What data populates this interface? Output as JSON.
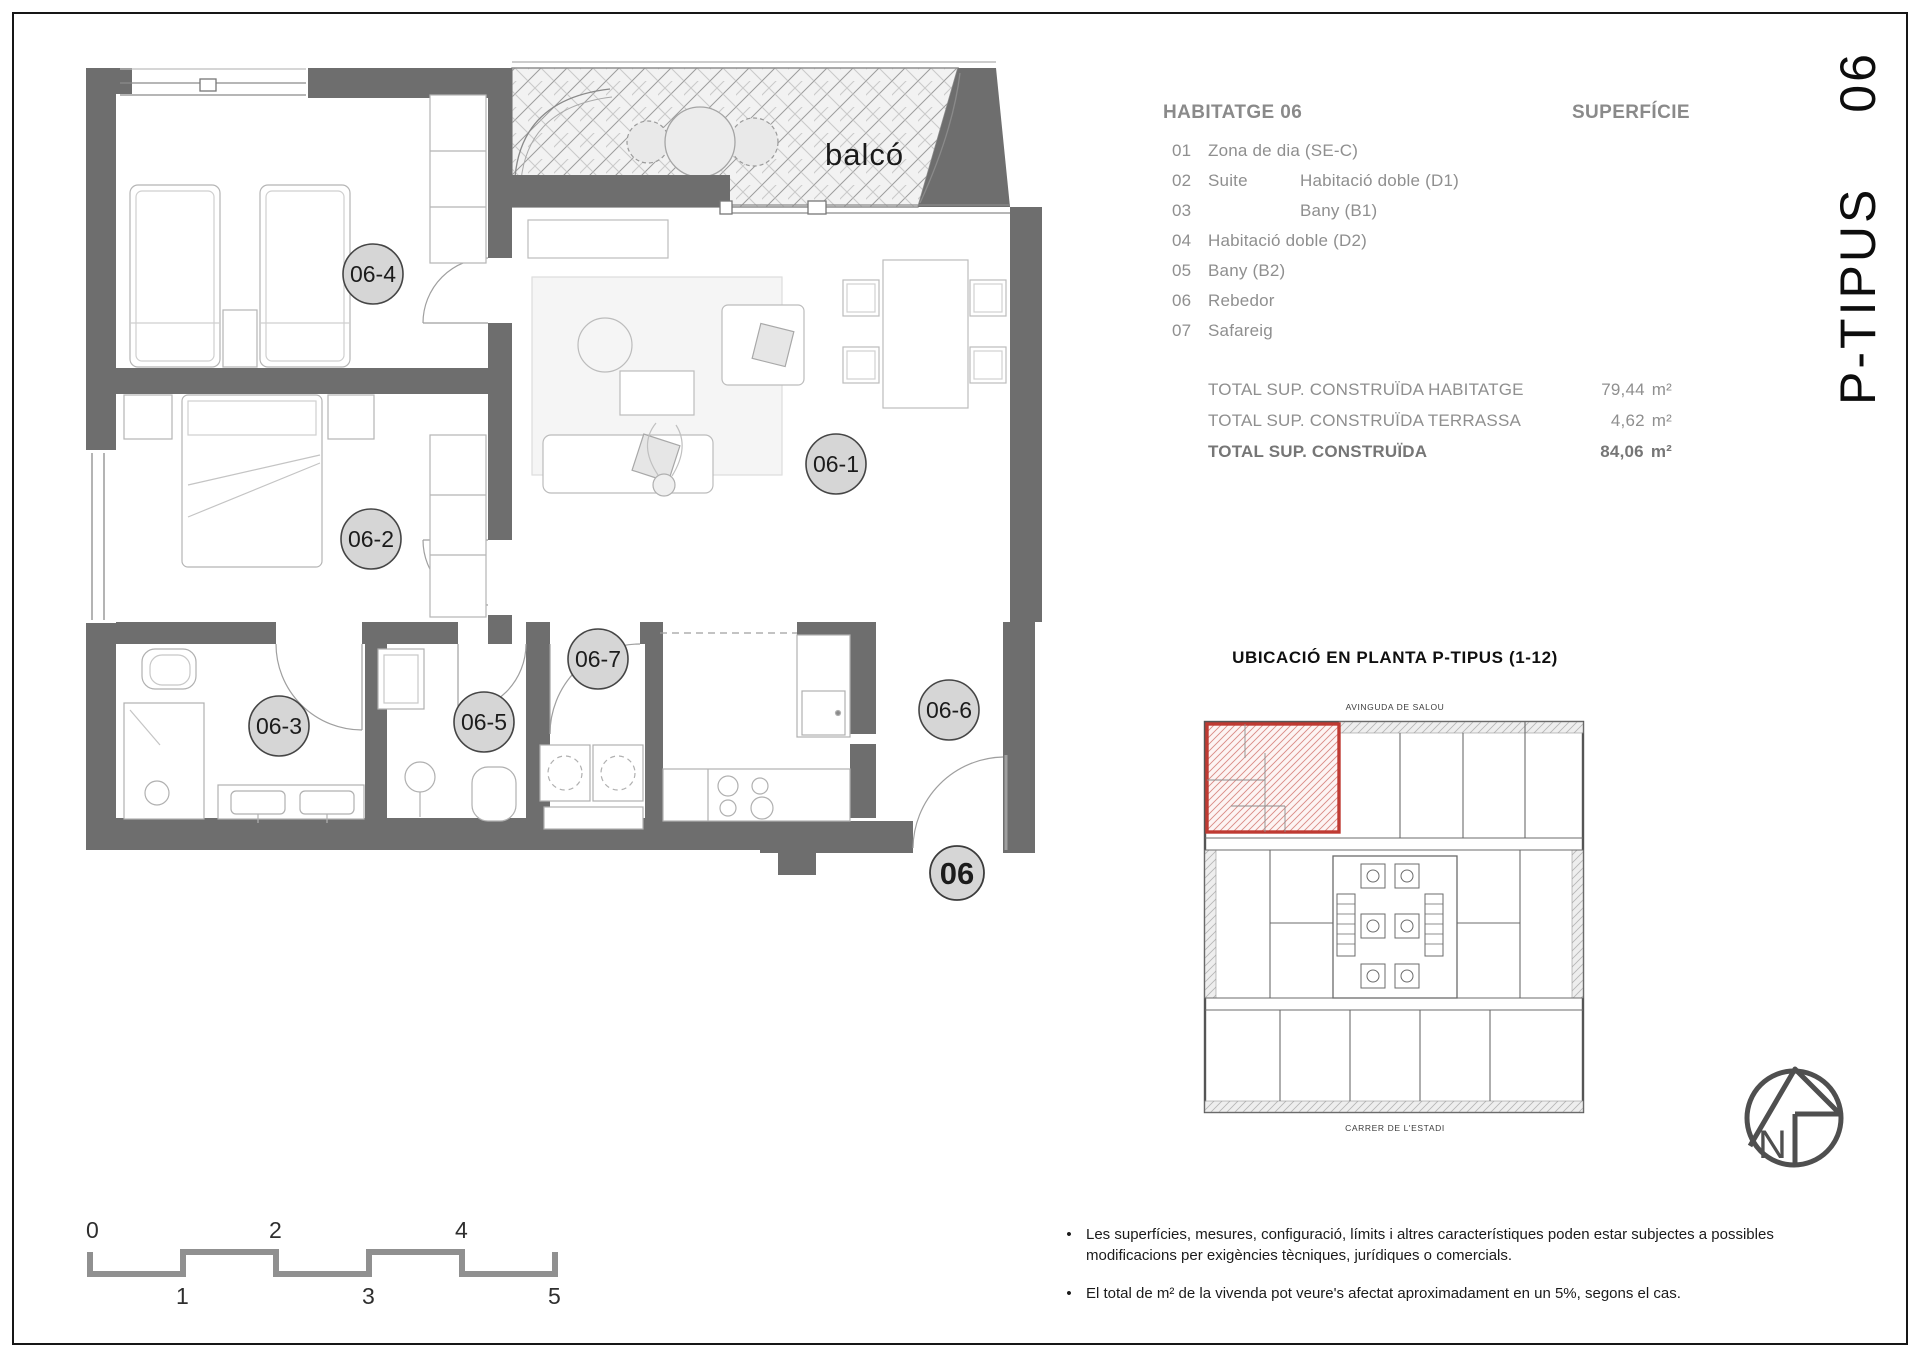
{
  "sheet": {
    "code_prefix": "P-TIPUS",
    "code_number": "06"
  },
  "legend": {
    "title": "HABITATGE 06",
    "superficie_label": "SUPERFÍCIE",
    "items": [
      {
        "num": "01",
        "col1": "Zona de dia (SE-C)",
        "col2": ""
      },
      {
        "num": "02",
        "col1": "Suite",
        "col2": "Habitació doble (D1)"
      },
      {
        "num": "03",
        "col1": "",
        "col2": "Bany (B1)"
      },
      {
        "num": "04",
        "col1": "Habitació doble (D2)",
        "col2": ""
      },
      {
        "num": "05",
        "col1": "Bany (B2)",
        "col2": ""
      },
      {
        "num": "06",
        "col1": "Rebedor",
        "col2": ""
      },
      {
        "num": "07",
        "col1": "Safareig",
        "col2": ""
      }
    ]
  },
  "totals": {
    "rows": [
      {
        "label": "TOTAL SUP. CONSTRUÏDA HABITATGE",
        "value": "79,44",
        "unit": "m²"
      },
      {
        "label": "TOTAL SUP. CONSTRUÏDA TERRASSA",
        "value": "4,62",
        "unit": "m²"
      },
      {
        "label": "TOTAL SUP. CONSTRUÏDA",
        "value": "84,06",
        "unit": "m²"
      }
    ]
  },
  "location": {
    "title": "UBICACIÓ EN PLANTA P-TIPUS (1-12)",
    "street_top": "AVINGUDA DE SALOU",
    "street_bottom": "CARRER DE L'ESTADI"
  },
  "plan": {
    "balcony_label": "balcó",
    "room_tags": [
      "06-1",
      "06-2",
      "06-3",
      "06-4",
      "06-5",
      "06-6",
      "06-7"
    ],
    "entry_tag": "06"
  },
  "scalebar": {
    "top": [
      "0",
      "2",
      "4"
    ],
    "bottom": [
      "1",
      "3",
      "5"
    ]
  },
  "notes": {
    "bullets": [
      "Les superfícies, mesures, configuració, límits i altres característiques poden estar subjectes a possibles modificacions per exigències tècniques, jurídiques o comercials.",
      "El total de m² de la vivenda pot veure's afectat aproximadament en un 5%, segons el cas."
    ]
  },
  "north": {
    "label": "N"
  },
  "colors": {
    "wall_gray": "#6e6e6e",
    "line_gray": "#b0b0b0",
    "legend_gray": "#8f8f8f",
    "accent_red": "#bf3a32",
    "tag_fill": "#d6d6d6"
  }
}
